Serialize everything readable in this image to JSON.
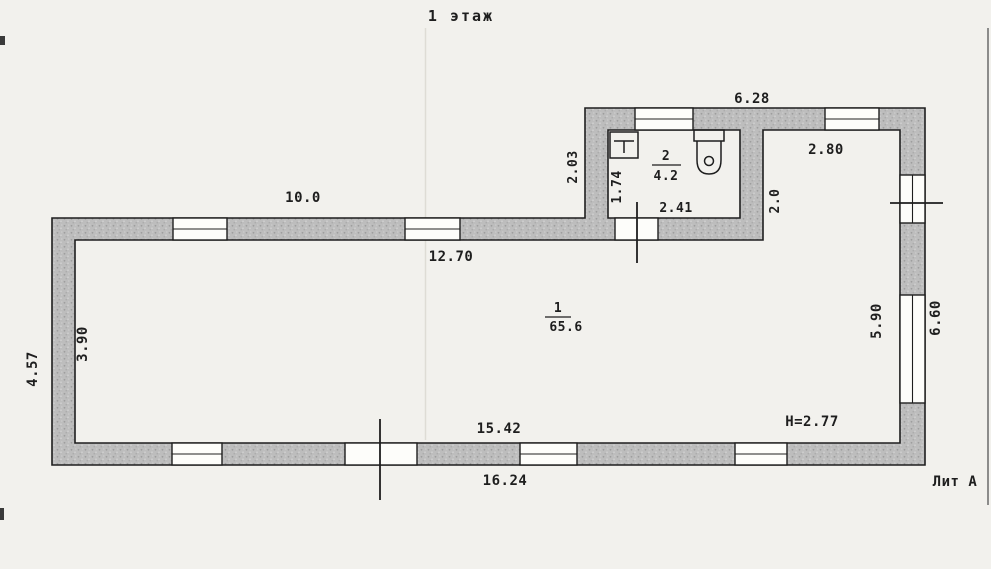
{
  "colors": {
    "paper": "#f2f1ed",
    "ink": "#1e1e1e",
    "wall_fill": "#bdbdbd",
    "wall_dot_dark": "#9e9e9e",
    "wall_dot_light": "#d4d4d4",
    "faint_line": "#dedcd5",
    "scan_line": "#6b6b6b"
  },
  "title": "1 этаж",
  "floor_plan": {
    "rooms": [
      {
        "number": "1",
        "area": "65.6"
      },
      {
        "number": "2",
        "area": "4.2"
      }
    ],
    "dims": {
      "top_wing_outer": "6.28",
      "hall_width": "2.80",
      "wing_left_outer": "2.03",
      "bath_inner_height": "1.74",
      "bath_inner_width": "2.41",
      "hall_depth": "2.0",
      "top_left_outer": "10.0",
      "main_inner_width_top": "12.70",
      "left_outer": "4.57",
      "left_inner": "3.90",
      "right_inner": "5.90",
      "right_outer": "6.60",
      "bottom_inner": "15.42",
      "bottom_outer": "16.24"
    },
    "ceiling_height": "H=2.77",
    "litera": "Лит А"
  }
}
